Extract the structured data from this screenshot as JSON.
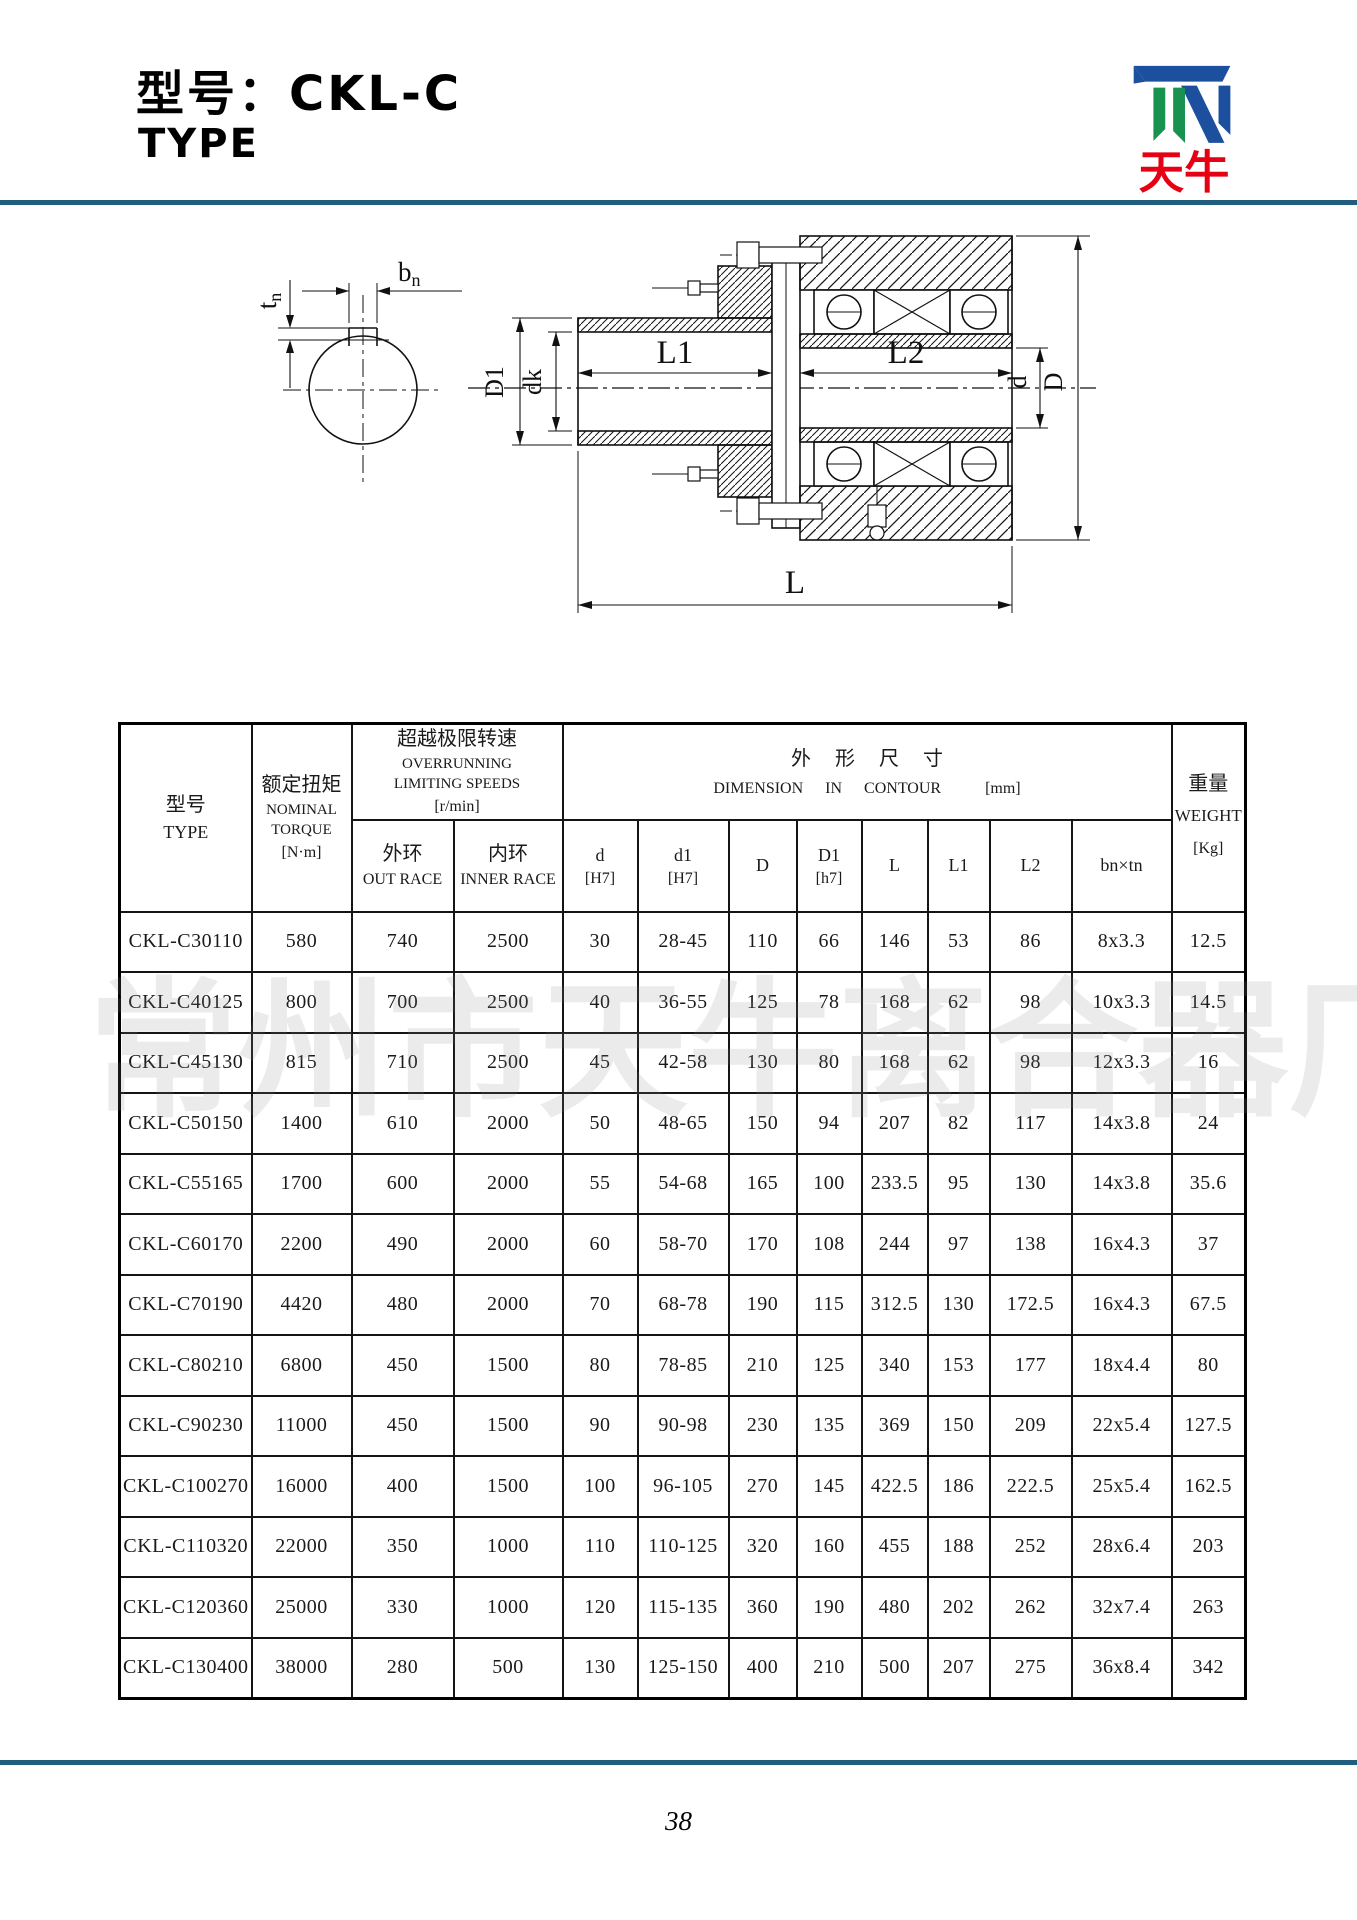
{
  "header": {
    "title": "型号：CKL-C",
    "subtitle": "TYPE",
    "rule_color": "#215e7d"
  },
  "logo": {
    "name_cn": "天牛",
    "blue": "#1c4f9e",
    "green": "#17934f",
    "red": "#e60014"
  },
  "watermark": {
    "text": "常州市天牛离合器厂"
  },
  "drawing": {
    "labels": {
      "l1": "L1",
      "l2": "L2",
      "l": "L",
      "big_d": "D",
      "small_d": "d",
      "d1": "D1",
      "dk": "dk",
      "b": "b",
      "t": "t",
      "sub": "n"
    }
  },
  "table": {
    "header": {
      "type": {
        "cn": "型号",
        "en": "TYPE"
      },
      "torque": {
        "cn": "额定扭矩",
        "en1": "NOMINAL",
        "en2": "TORQUE",
        "unit": "[N·m]"
      },
      "speed": {
        "cn": "超越极限转速",
        "en1": "OVERRUNNING",
        "en2": "LIMITING SPEEDS",
        "unit": "[r/min]"
      },
      "out_race": {
        "cn": "外环",
        "en": "OUT RACE"
      },
      "inner_race": {
        "cn": "内环",
        "en": "INNER RACE"
      },
      "dimension": {
        "cn": "外形尺寸",
        "en": "DIMENSION IN CONTOUR",
        "unit": "[mm]"
      },
      "dim_cols": [
        {
          "l1": "d",
          "l2": "[H7]"
        },
        {
          "l1": "d1",
          "l2": "[H7]"
        },
        {
          "l1": "D",
          "l2": ""
        },
        {
          "l1": "D1",
          "l2": "[h7]"
        },
        {
          "l1": "L",
          "l2": ""
        },
        {
          "l1": "L1",
          "l2": ""
        },
        {
          "l1": "L2",
          "l2": ""
        },
        {
          "l1": "bn×tn",
          "l2": ""
        }
      ],
      "weight": {
        "cn": "重量",
        "en": "WEIGHT",
        "unit": "[Kg]"
      }
    },
    "col_keys": [
      "type",
      "nominal_torque",
      "out_race",
      "inner_race",
      "d",
      "d1",
      "D",
      "D1",
      "L",
      "L1",
      "L2",
      "bn_tn",
      "weight"
    ],
    "rows": [
      [
        "CKL-C30110",
        "580",
        "740",
        "2500",
        "30",
        "28-45",
        "110",
        "66",
        "146",
        "53",
        "86",
        "8x3.3",
        "12.5"
      ],
      [
        "CKL-C40125",
        "800",
        "700",
        "2500",
        "40",
        "36-55",
        "125",
        "78",
        "168",
        "62",
        "98",
        "10x3.3",
        "14.5"
      ],
      [
        "CKL-C45130",
        "815",
        "710",
        "2500",
        "45",
        "42-58",
        "130",
        "80",
        "168",
        "62",
        "98",
        "12x3.3",
        "16"
      ],
      [
        "CKL-C50150",
        "1400",
        "610",
        "2000",
        "50",
        "48-65",
        "150",
        "94",
        "207",
        "82",
        "117",
        "14x3.8",
        "24"
      ],
      [
        "CKL-C55165",
        "1700",
        "600",
        "2000",
        "55",
        "54-68",
        "165",
        "100",
        "233.5",
        "95",
        "130",
        "14x3.8",
        "35.6"
      ],
      [
        "CKL-C60170",
        "2200",
        "490",
        "2000",
        "60",
        "58-70",
        "170",
        "108",
        "244",
        "97",
        "138",
        "16x4.3",
        "37"
      ],
      [
        "CKL-C70190",
        "4420",
        "480",
        "2000",
        "70",
        "68-78",
        "190",
        "115",
        "312.5",
        "130",
        "172.5",
        "16x4.3",
        "67.5"
      ],
      [
        "CKL-C80210",
        "6800",
        "450",
        "1500",
        "80",
        "78-85",
        "210",
        "125",
        "340",
        "153",
        "177",
        "18x4.4",
        "80"
      ],
      [
        "CKL-C90230",
        "11000",
        "450",
        "1500",
        "90",
        "90-98",
        "230",
        "135",
        "369",
        "150",
        "209",
        "22x5.4",
        "127.5"
      ],
      [
        "CKL-C100270",
        "16000",
        "400",
        "1500",
        "100",
        "96-105",
        "270",
        "145",
        "422.5",
        "186",
        "222.5",
        "25x5.4",
        "162.5"
      ],
      [
        "CKL-C110320",
        "22000",
        "350",
        "1000",
        "110",
        "110-125",
        "320",
        "160",
        "455",
        "188",
        "252",
        "28x6.4",
        "203"
      ],
      [
        "CKL-C120360",
        "25000",
        "330",
        "1000",
        "120",
        "115-135",
        "360",
        "190",
        "480",
        "202",
        "262",
        "32x7.4",
        "263"
      ],
      [
        "CKL-C130400",
        "38000",
        "280",
        "500",
        "130",
        "125-150",
        "400",
        "210",
        "500",
        "207",
        "275",
        "36x8.4",
        "342"
      ]
    ]
  },
  "footer": {
    "page_number": "38"
  }
}
